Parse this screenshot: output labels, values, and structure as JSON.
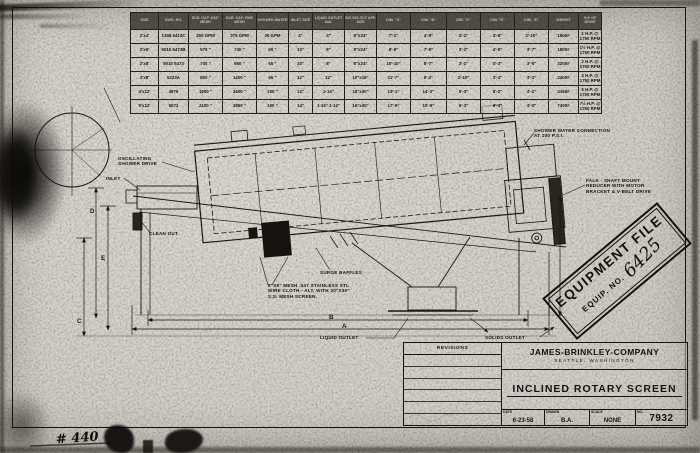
{
  "sheet": {
    "paper_color": "#d6d4ce",
    "ink_color": "#1b1813"
  },
  "spec_table": {
    "headers": [
      "SIZE",
      "DWG. NO.",
      "SCR. CAP. 3/16\" MESH",
      "SCR. CAP. FINE MESH",
      "SHOWER WATER",
      "INLET SIZE",
      "LIQUID OUTLET DIA.",
      "SOLIDS OUT APP. SIZE",
      "DIM. \"A\"",
      "DIM. \"B\"",
      "DIM. \"C\"",
      "DIM. \"D\"",
      "DIM. \"E\"",
      "WEIGHT",
      "H.P. OF DRIVE"
    ],
    "rows": [
      [
        "2'x4'",
        "1348 5413C",
        "250 GPM",
        "375 GPM",
        "30 GPM",
        "4\"",
        "4\"",
        "8\"x24\"",
        "7'-1\"",
        "4'-9\"",
        "3'-1\"",
        "3'-9\"",
        "2'-10\"",
        "1600#",
        "1 H.P. @ 1750 RPM"
      ],
      [
        "2'x6'",
        "6015 5473B",
        "575 \"",
        "740 \"",
        "50 \"",
        "10\"",
        "8\"",
        "8\"x24\"",
        "8'-9\"",
        "7'-5\"",
        "3'-2\"",
        "4'-5\"",
        "3'-7\"",
        "1800#",
        "1½ H.P. @ 1750 RPM"
      ],
      [
        "2'x8'",
        "5010 5473",
        "700 \"",
        "950 \"",
        "65 \"",
        "10\"",
        "8\"",
        "8\"x24\"",
        "10'-10\"",
        "8'-7\"",
        "3'-1\"",
        "4'-3\"",
        "3'-5\"",
        "2200#",
        "2 H.P. @ 1750 RPM"
      ],
      [
        "3'x8'",
        "5223A",
        "800 \"",
        "1400 \"",
        "65 \"",
        "12\"",
        "12\"",
        "10\"x18\"",
        "11'-7\"",
        "9'-2\"",
        "3'-10\"",
        "3'-3\"",
        "3'-2\"",
        "2400#",
        "3 H.P. @ 1750 RPM"
      ],
      [
        "4'x12'",
        "4976",
        "1500 \"",
        "2600 \"",
        "100 \"",
        "12\"",
        "2-14\"",
        "18\"x30\"",
        "13'-1\"",
        "14'-2\"",
        "5'-3\"",
        "8'-2\"",
        "4'-1\"",
        "4160#",
        "5 H.P. @ 1750 RPM"
      ],
      [
        "5'x12'",
        "5071",
        "2100 \"",
        "2860 \"",
        "100 \"",
        "14\"",
        "1-16\" 1-12\"",
        "16\"x30\"",
        "17'-9\"",
        "15'-9\"",
        "6'-3\"",
        "8'-4\"",
        "4'-0\"",
        "7400#",
        "7½ H.P. @ 1750 RPM"
      ]
    ]
  },
  "callouts": {
    "shower_connection": "SHOWER WATER CONNECTION\nAT 100 P.S.I.",
    "reducer": "FALK - SHAFT MOUNT\nREDUCER WITH MOTOR\nBRACKET & V-BELT DRIVE",
    "oscillating_shower": "OSCILLATING\nSHOWER DRIVE",
    "inlet": "INLET",
    "clean_out": "CLEAN OUT",
    "surge_baffles": "SURGE BAFFLES",
    "mesh_note": "8\"x8\" MESH .047 STAINLESS STL\nWIRE CLOTH - ALT. WITH 30\"x30\"\nS.S. MESH SCREEN.",
    "liquid_outlet": "LIQUID OUTLET",
    "solids_outlet": "SOLIDS OUTLET"
  },
  "dim_labels": {
    "a": "A",
    "b": "B",
    "c": "C",
    "d": "D",
    "e": "E"
  },
  "stamp": {
    "title": "EQUIPMENT FILE",
    "equip_no_label": "EQUIP. NO.",
    "equip_no_value": "6425"
  },
  "title_block": {
    "revisions_label": "REVISIONS",
    "company_name": "JAMES-BRINKLEY-COMPANY",
    "company_city": "SEATTLE, WASHINGTON",
    "drawing_title": "INCLINED ROTARY SCREEN",
    "date_label": "DATE",
    "date_value": "6-23-58",
    "drawn_label": "DRAWN",
    "drawn_value": "B.A.",
    "scale_label": "SCALE",
    "scale_value": "NONE",
    "no_label": "NO.",
    "no_value": "7932"
  },
  "handwriting": {
    "bottom_left": "# 440"
  }
}
